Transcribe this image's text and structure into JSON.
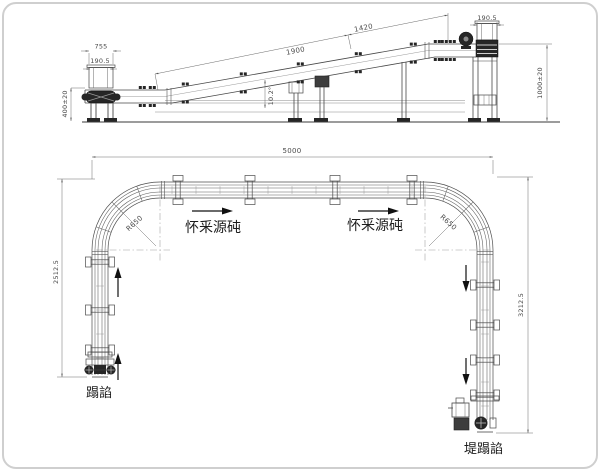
{
  "drawing_type": "conveyor-system-technical-drawing",
  "elevation": {
    "dims": {
      "w755": "755",
      "w190_left": "190.5",
      "h400": "400±20",
      "len1900": "1900",
      "len1420": "1420",
      "angle": "10.2°",
      "w190_right": "190.5",
      "h1000": "1000±20"
    }
  },
  "plan": {
    "dims": {
      "total": "5000",
      "left": "2512.5",
      "right": "3212.5",
      "radius_left": "R650",
      "radius_right": "R650"
    },
    "labels": {
      "flow_left": "怀釆源砘",
      "flow_right": "怀釆源砘",
      "infeed": "蹋諂",
      "outfeed": "堤蹋諂"
    }
  },
  "colors": {
    "line": "#474747",
    "rail": "#5a5a5a",
    "dim_line": "#6b6b6b",
    "centerline": "#9f9f9f",
    "dark_fill": "#262626",
    "border": "#cfcfcf"
  }
}
